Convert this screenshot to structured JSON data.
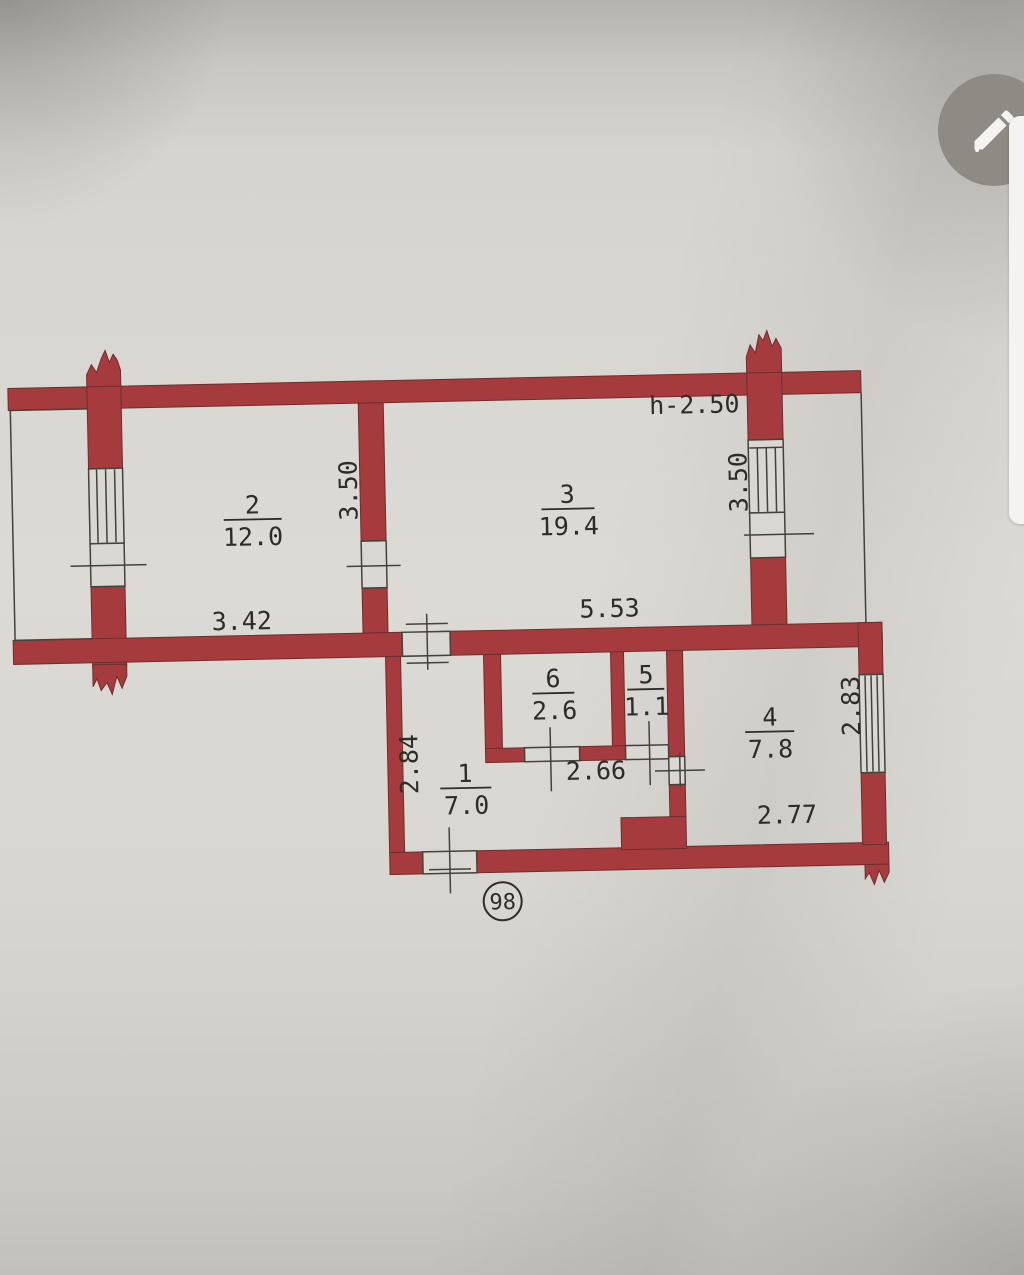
{
  "colors": {
    "wall": "#a63b3d",
    "walledge": "#6f2d2e",
    "paper": "#dad8d3",
    "line": "#45413c",
    "ink": "#2e2c29"
  },
  "photo": {
    "edit_button_icon": "pencil-icon"
  },
  "plan": {
    "height_note": "h-2.50",
    "apartment_number": "98",
    "rooms": {
      "r1": {
        "number": "1",
        "area": "7.0"
      },
      "r2": {
        "number": "2",
        "area": "12.0"
      },
      "r3": {
        "number": "3",
        "area": "19.4"
      },
      "r4": {
        "number": "4",
        "area": "7.8"
      },
      "r5": {
        "number": "5",
        "area": "1.1"
      },
      "r6": {
        "number": "6",
        "area": "2.6"
      }
    },
    "dimensions": {
      "room2_width": "3.42",
      "room3_width": "5.53",
      "hall_width": "2.66",
      "room4_width": "2.77",
      "room2_depth": "3.50",
      "room3_depth": "3.50",
      "hall_depth": "2.84",
      "room4_depth": "2.83"
    }
  }
}
